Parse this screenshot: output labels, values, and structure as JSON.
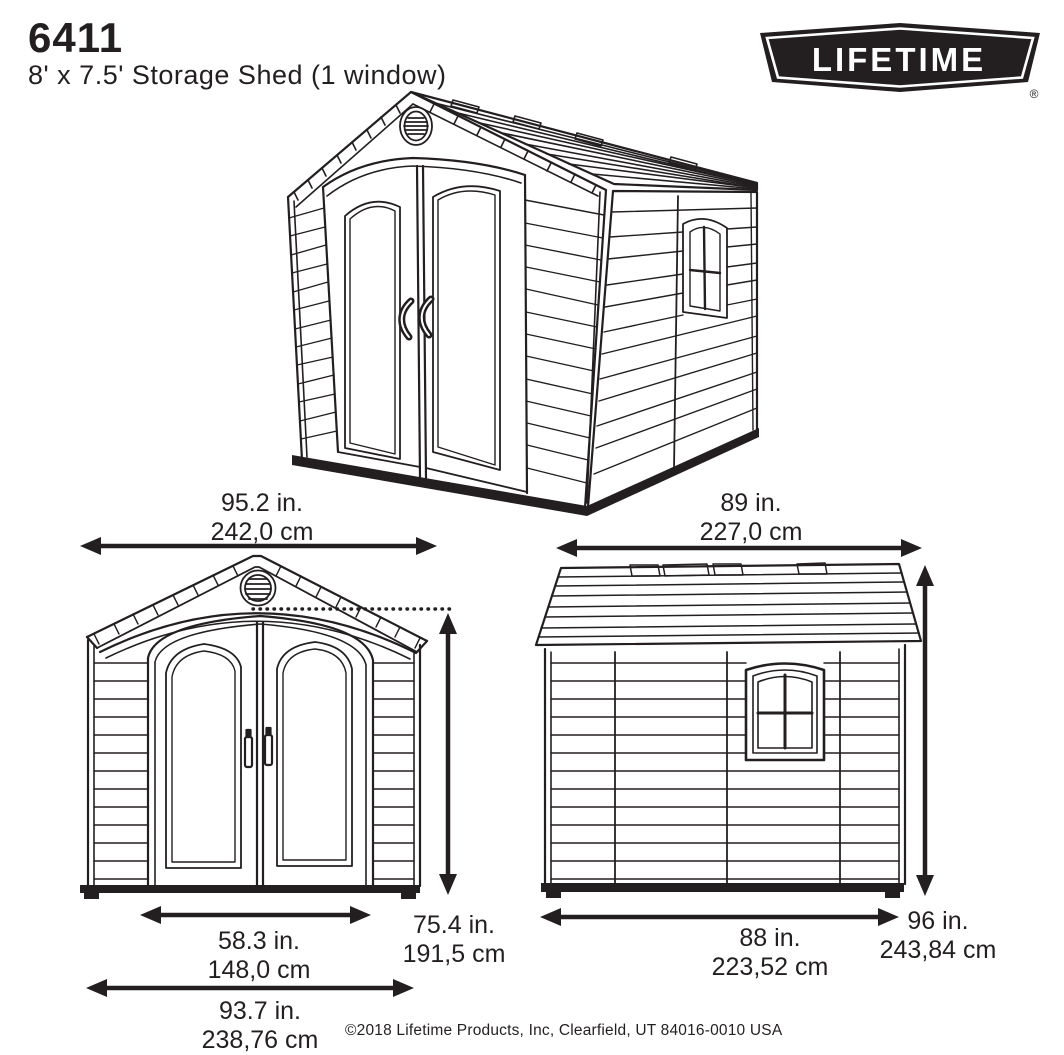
{
  "header": {
    "model": "6411",
    "subtitle": "8' x 7.5' Storage Shed (1 window)",
    "brand": "LIFETIME",
    "registered": "®"
  },
  "dimensions": {
    "front_width": {
      "in": "95.2 in.",
      "cm": "242,0 cm"
    },
    "side_depth": {
      "in": "89 in.",
      "cm": "227,0 cm"
    },
    "door_width": {
      "in": "58.3 in.",
      "cm": "148,0 cm"
    },
    "wall_height": {
      "in": "75.4 in.",
      "cm": "191,5 cm"
    },
    "base_width": {
      "in": "93.7 in.",
      "cm": "238,76 cm"
    },
    "base_depth": {
      "in": "88 in.",
      "cm": "223,52 cm"
    },
    "peak_height": {
      "in": "96 in.",
      "cm": "243,84 cm"
    }
  },
  "footer": {
    "copyright": "©2018 Lifetime Products, Inc, Clearfield, UT 84016-0010 USA"
  },
  "colors": {
    "ink": "#231f20",
    "background": "#ffffff"
  }
}
